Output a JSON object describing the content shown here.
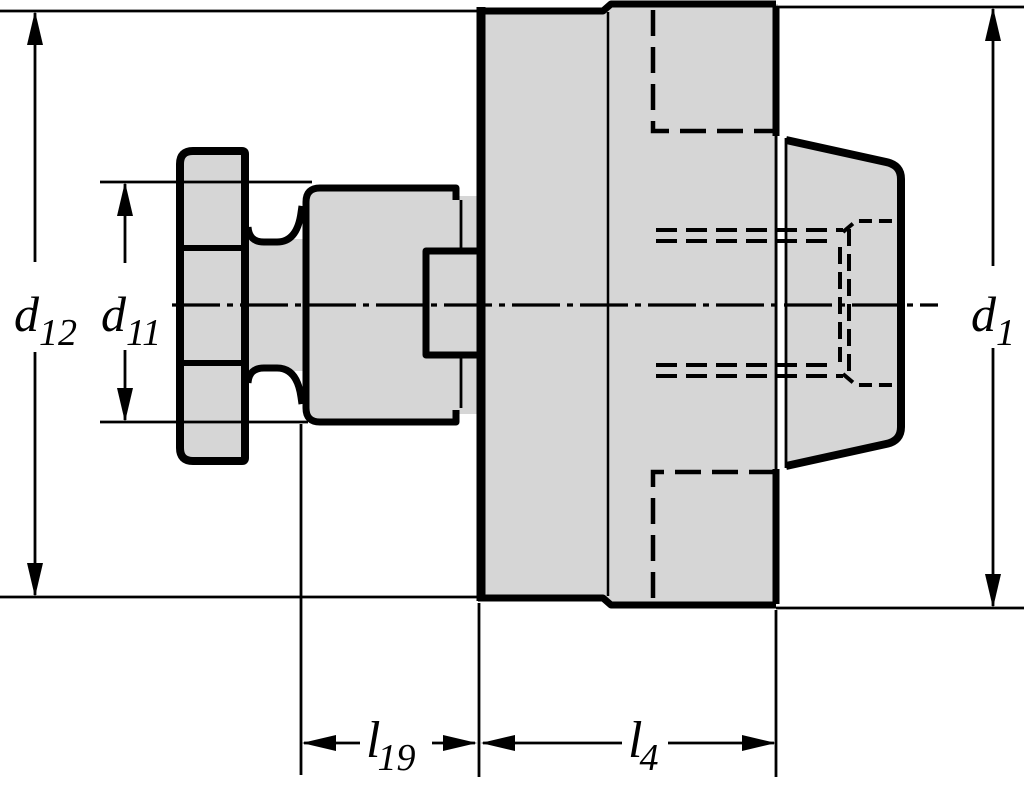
{
  "drawing": {
    "background": "#ffffff",
    "part_fill": "#d6d6d6",
    "line_color": "#000000",
    "labels": {
      "d12_base": "d",
      "d12_sub": "12",
      "d11_base": "d",
      "d11_sub": "11",
      "d1_base": "d",
      "d1_sub": "1",
      "l19_base": "l",
      "l19_sub": "19",
      "l4_base": "l",
      "l4_sub": "4"
    }
  }
}
